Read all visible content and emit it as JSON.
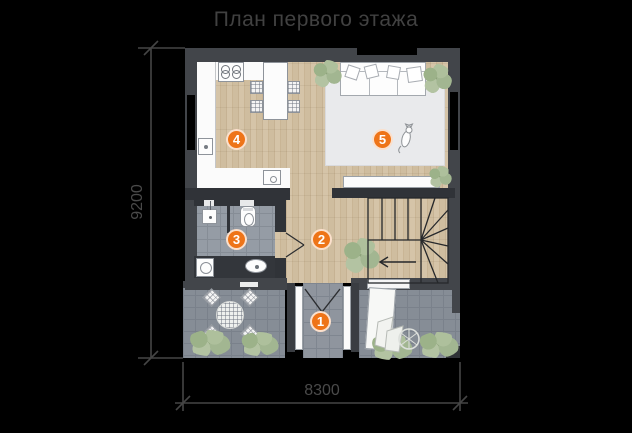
{
  "title": "План первого этажа",
  "dimensions": {
    "height_label": "9200",
    "width_label": "8300"
  },
  "markers": [
    "1",
    "2",
    "3",
    "4",
    "5"
  ],
  "colors": {
    "background": "#000000",
    "wall": "#42454a",
    "accent_orange": "#ee7418",
    "title_text": "#414141",
    "dim_text": "#4a4a4a",
    "wood_floor": "#cdbb9e",
    "bath_tile": "#959ca5",
    "terrace_tile": "#868d96",
    "rug": "#e9eaec",
    "plant_green": "#a7b994"
  }
}
